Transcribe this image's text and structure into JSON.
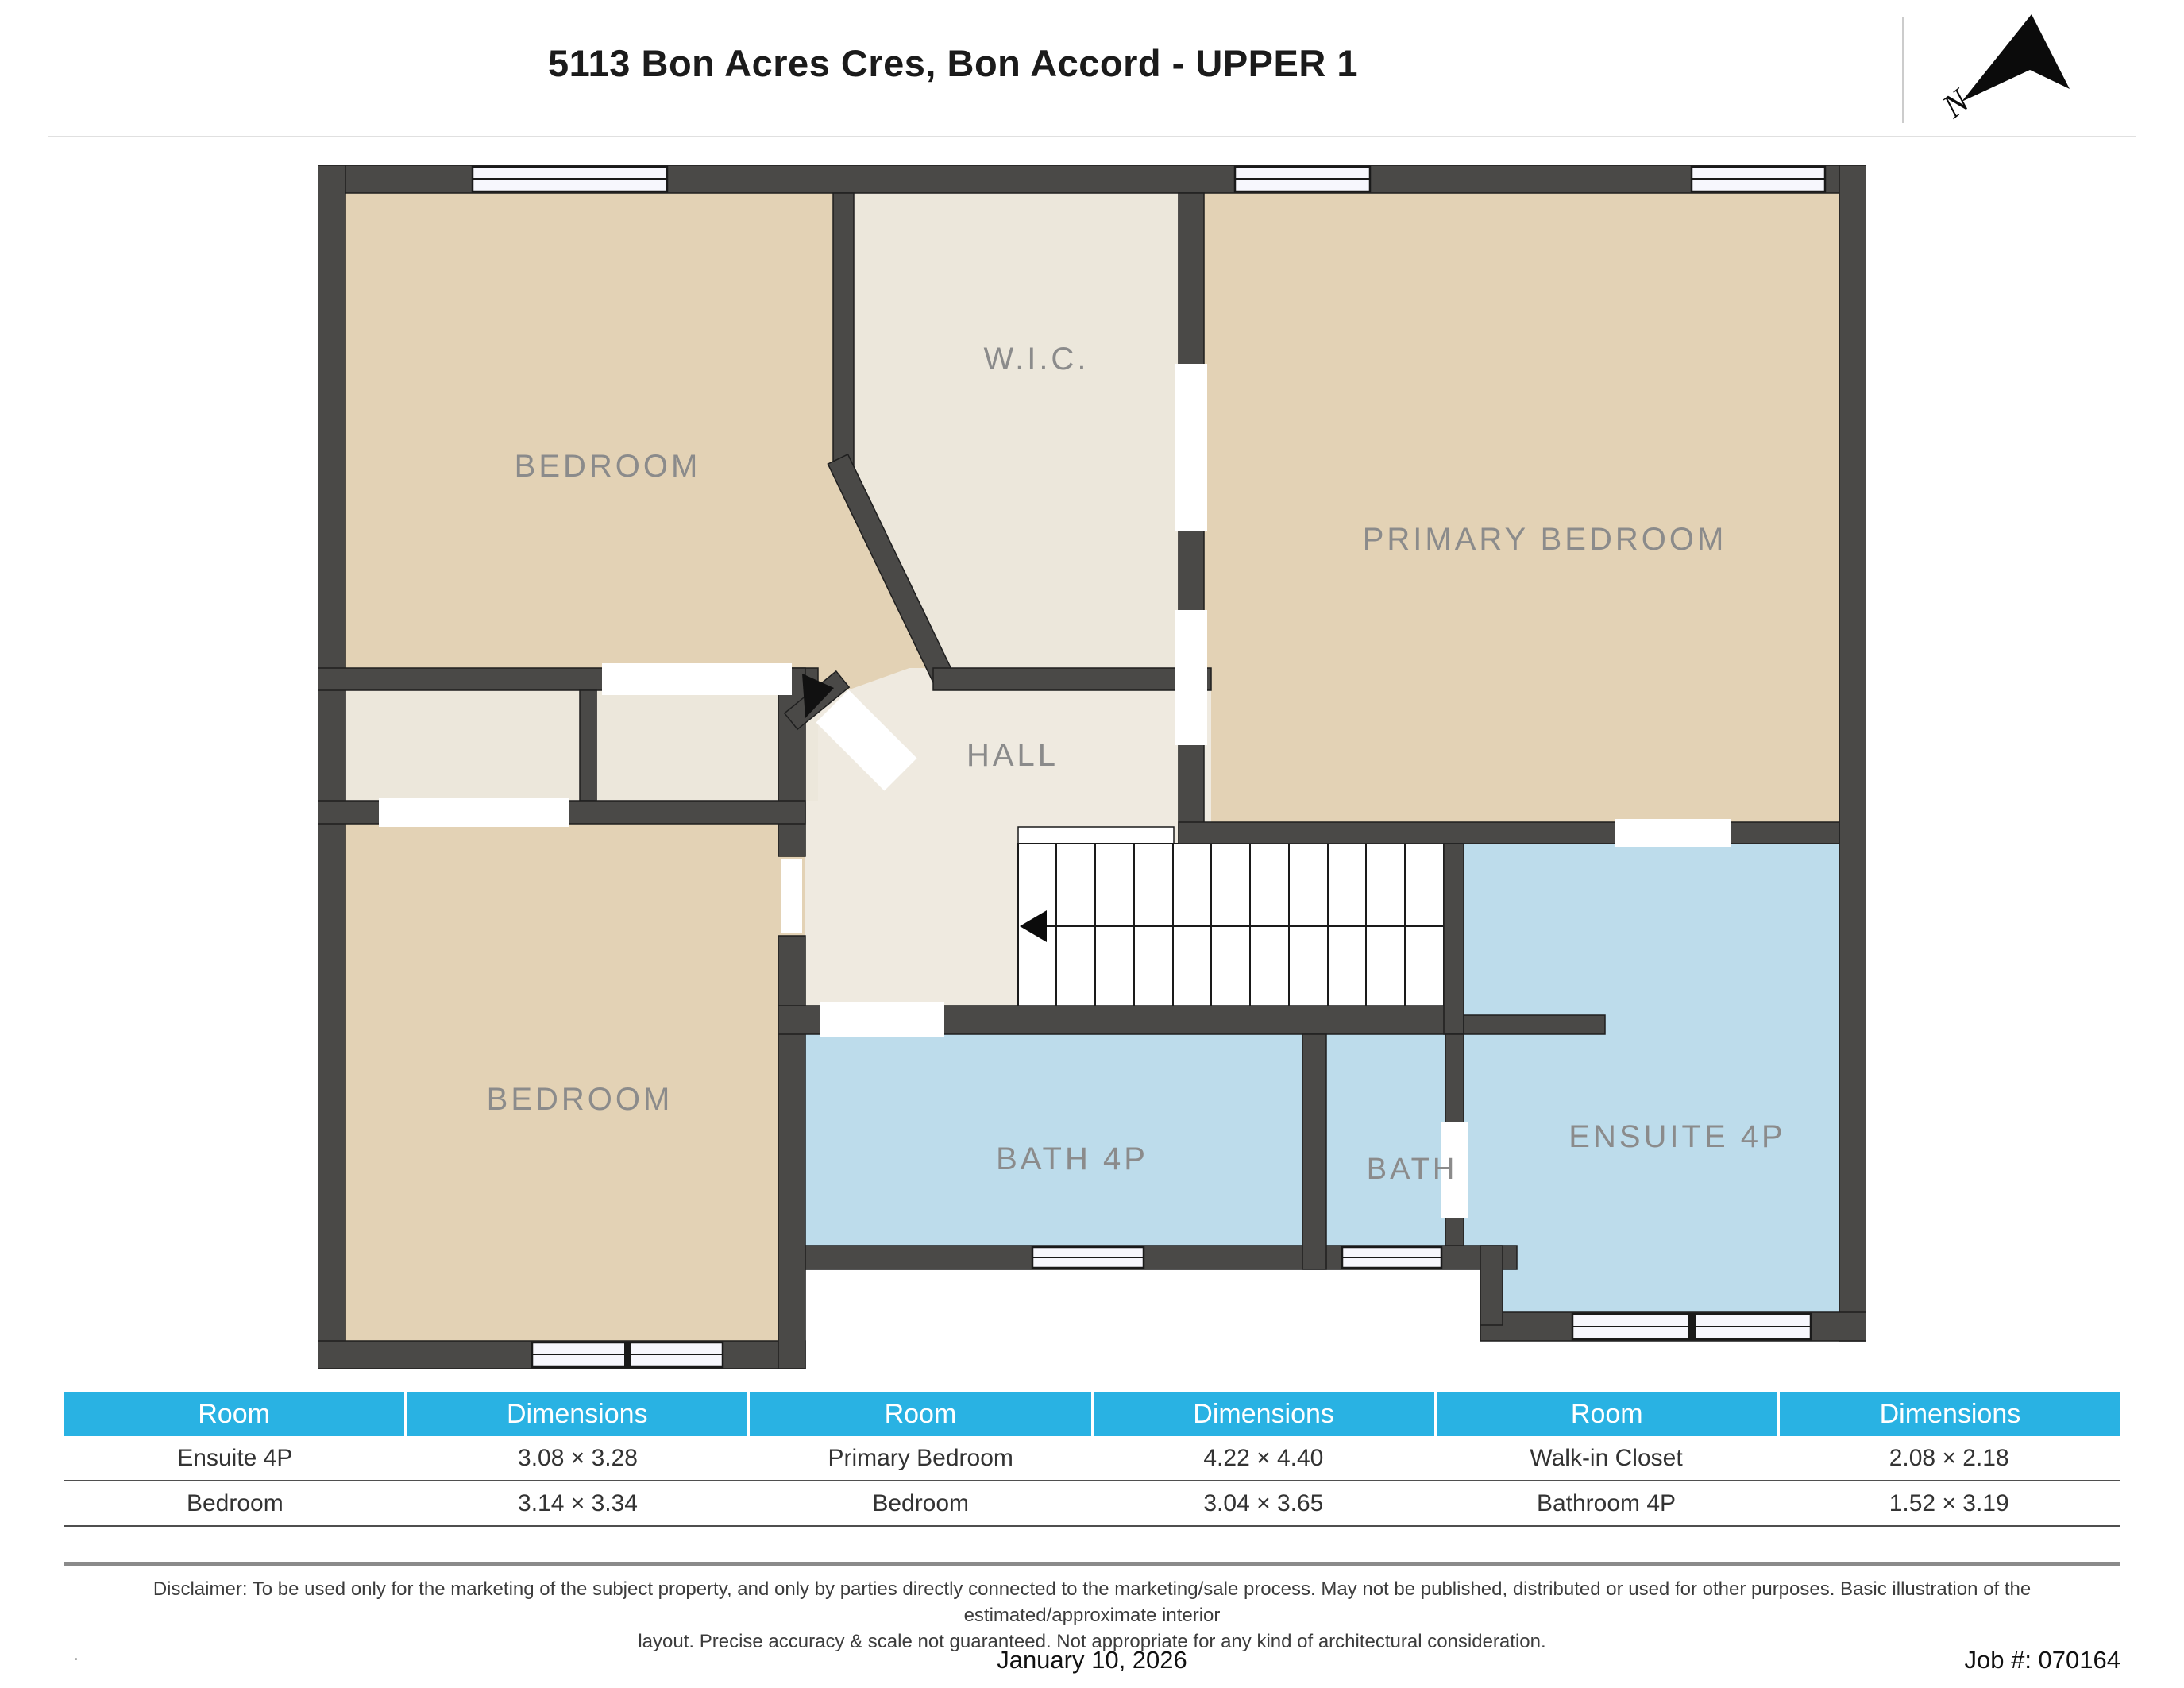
{
  "header": {
    "title": "5113 Bon Acres Cres, Bon Accord - UPPER 1",
    "north_label": "N"
  },
  "plan": {
    "rooms": [
      {
        "name": "bedroom-top-left",
        "label": "BEDROOM"
      },
      {
        "name": "walk-in-closet",
        "label": "W.I.C."
      },
      {
        "name": "primary-bedroom",
        "label": "PRIMARY BEDROOM"
      },
      {
        "name": "hall",
        "label": "HALL"
      },
      {
        "name": "bedroom-bottom-left",
        "label": "BEDROOM"
      },
      {
        "name": "bath-4p",
        "label": "BATH 4P"
      },
      {
        "name": "bath",
        "label": "BATH"
      },
      {
        "name": "ensuite-4p",
        "label": "ENSUITE 4P"
      }
    ],
    "colors": {
      "wall": "#4a4947",
      "bedroom_fill": "#e3d2b5",
      "closet_fill": "#ece7db",
      "bath_fill": "#bddceb",
      "window_fill": "#f7f7fd"
    }
  },
  "table": {
    "headers": [
      "Room",
      "Dimensions",
      "Room",
      "Dimensions",
      "Room",
      "Dimensions"
    ],
    "rows": [
      [
        "Ensuite 4P",
        "3.08 × 3.28",
        "Primary Bedroom",
        "4.22 × 4.40",
        "Walk-in Closet",
        "2.08 × 2.18"
      ],
      [
        "Bedroom",
        "3.14 × 3.34",
        "Bedroom",
        "3.04 × 3.65",
        "Bathroom 4P",
        "1.52 × 3.19"
      ]
    ],
    "header_color": "#29b2e3"
  },
  "disclaimer": {
    "line1": "Disclaimer: To be used only for the marketing of the subject property, and only by parties directly connected to the marketing/sale process. May not be published, distributed or used for other purposes. Basic illustration of the estimated/approximate interior",
    "line2": "layout. Precise accuracy & scale not guaranteed. Not appropriate for any kind of architectural consideration."
  },
  "footer": {
    "date": "January 10, 2026",
    "job": "Job #: 070164"
  }
}
